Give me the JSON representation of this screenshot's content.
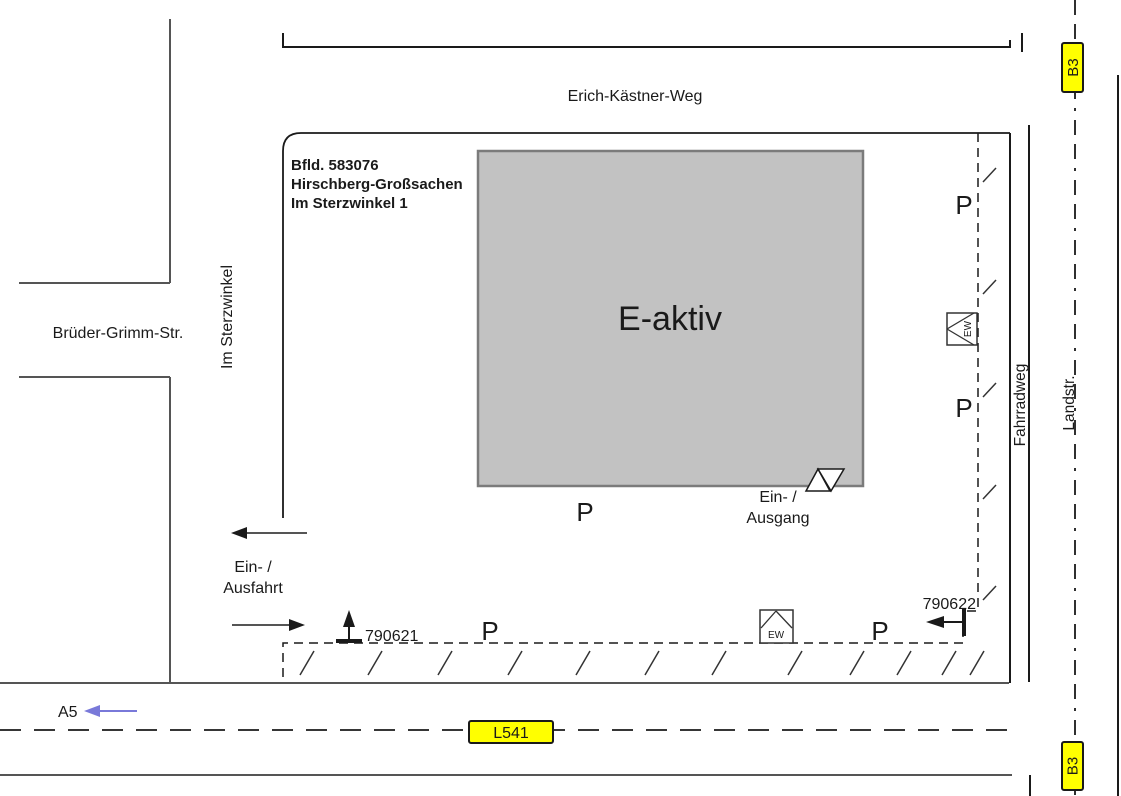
{
  "map": {
    "streets": {
      "erich_kastner_weg": "Erich-Kästner-Weg",
      "bruder_grimm_str": "Brüder-Grimm-Str.",
      "im_sterzwinkel": "Im Sterzwinkel",
      "fahrradweg": "Fahrradweg",
      "landstr": "Landstr."
    },
    "signs": {
      "b3": "B3",
      "l541": "L541",
      "a5": "A5",
      "sign_bg_color": "#ffff00",
      "a5_text_color": "#2626d0"
    },
    "parcel": {
      "line1": "Bfld. 583076",
      "line2": "Hirschberg-Großsachen",
      "line3": "Im Sterzwinkel 1"
    },
    "building": {
      "name": "E-aktiv",
      "fill_color": "#c2c2c2"
    },
    "labels": {
      "parking": "P",
      "ew_station": "EW",
      "building_entrance_line1": "Ein- /",
      "building_entrance_line2": "Ausgang",
      "site_entrance_line1": "Ein- /",
      "site_entrance_line2": "Ausfahrt"
    },
    "survey_markers": {
      "marker_south_west": "790621",
      "marker_south_east": "790622"
    }
  }
}
